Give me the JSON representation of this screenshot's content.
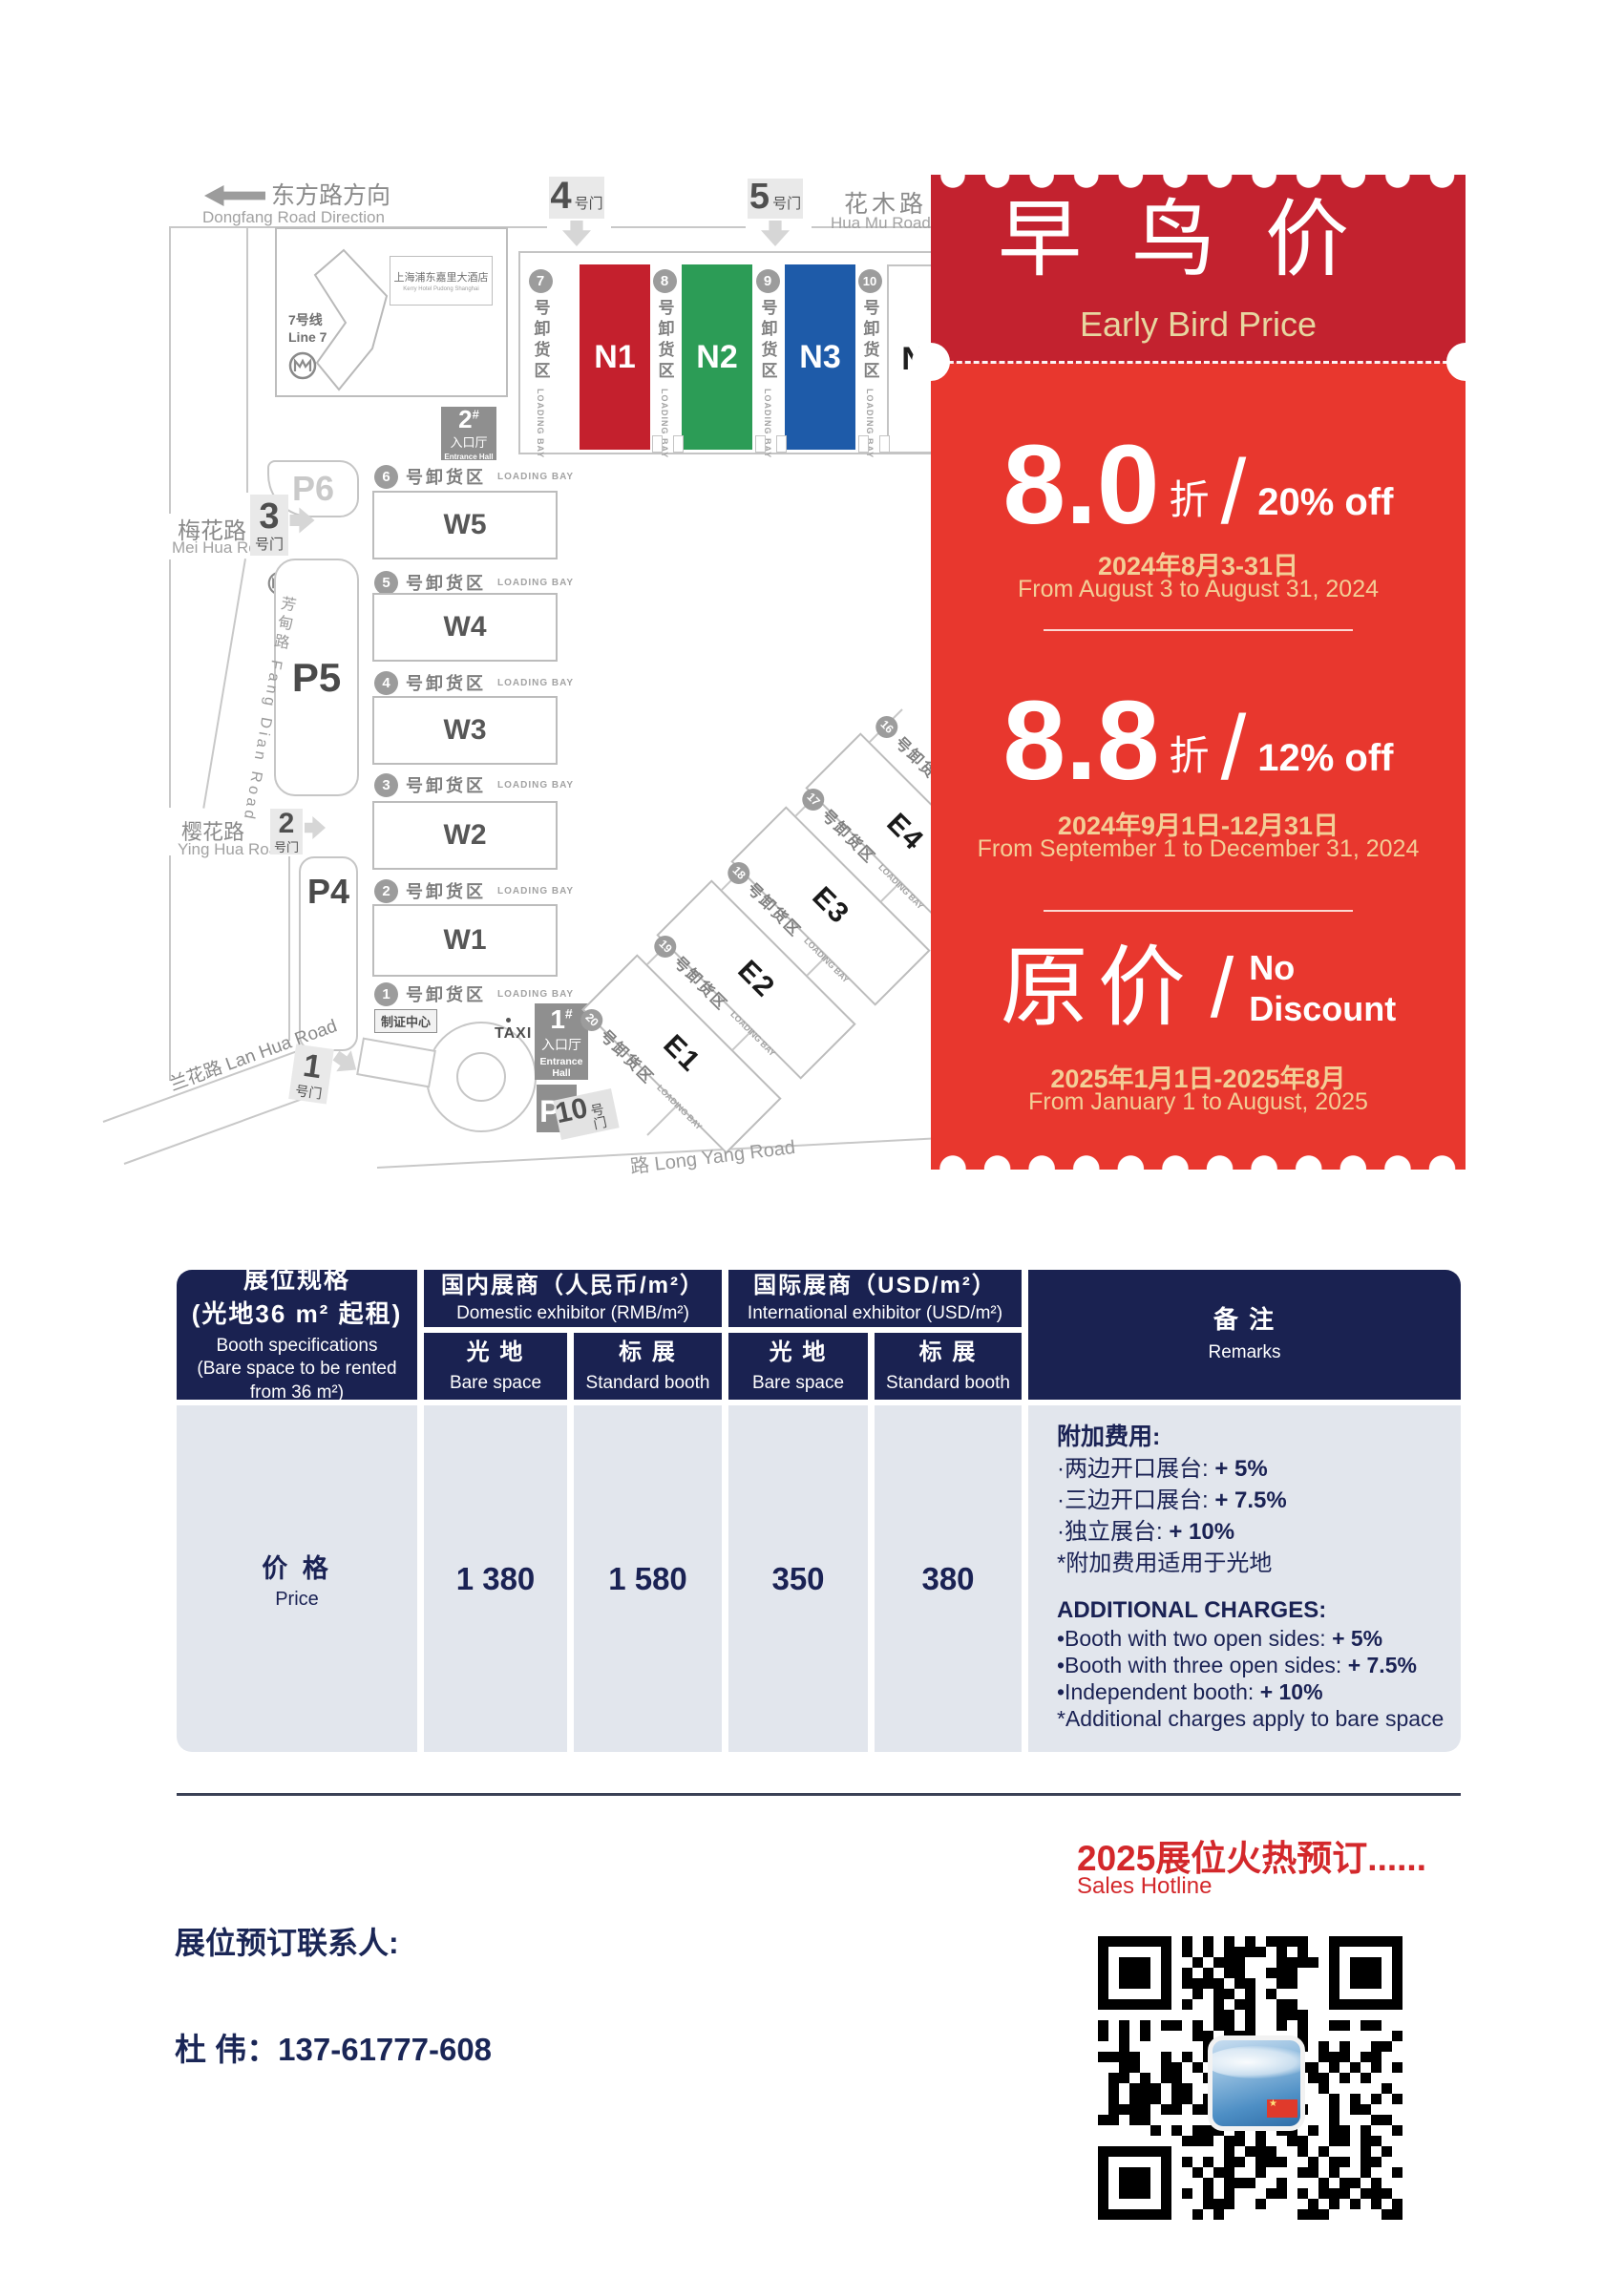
{
  "map": {
    "dongfang_cn": "东方路方向",
    "dongfang_en": "Dongfang Road Direction",
    "huamu_cn": "花木路",
    "huamu_en": "Hua Mu Road",
    "meihua_cn": "梅花路",
    "meihua_en": "Mei Hua Road",
    "yinghua_cn": "樱花路",
    "yinghua_en": "Ying Hua Road",
    "fangdian": "芳甸路 Fang Dian Road",
    "lanhua": "兰花路 Lan Hua Road",
    "longyang": "路 Long Yang Road",
    "hotel_cn": "上海浦东嘉里大酒店",
    "hotel_en": "Kerry Hotel Pudong Shanghai",
    "line7_cn": "7号线",
    "line7_en": "Line 7",
    "badge_center": "制证中心",
    "taxi": "TAXI",
    "gate_label": "号门",
    "gates": {
      "g1": "1",
      "g2": "2",
      "g3": "3",
      "g4": "4",
      "g5": "5",
      "g10": "10"
    },
    "parking": [
      "P6",
      "P5",
      "P4"
    ],
    "pvip": "P",
    "pvip_sub": "VIP",
    "hash": "#",
    "entrance1": {
      "num": "1",
      "cn": "入口厅",
      "en1": "Entrance",
      "en2": "Hall"
    },
    "entrance2": {
      "num": "2",
      "cn": "入口厅",
      "en": "Entrance Hall"
    },
    "halls_n": [
      "N1",
      "N2",
      "N3",
      "N4"
    ],
    "halls_w": [
      "W5",
      "W4",
      "W3",
      "W2",
      "W1"
    ],
    "halls_e": [
      "E1",
      "E2",
      "E3",
      "E4"
    ],
    "n_bays": [
      "7",
      "8",
      "9",
      "10"
    ],
    "w_bays": [
      "6",
      "5",
      "4",
      "3",
      "2",
      "1"
    ],
    "e_bays": [
      "16",
      "17",
      "18",
      "19",
      "20"
    ],
    "loading_cn": "号卸货区",
    "loading_en": "LOADING BAY"
  },
  "ticket": {
    "title_cn": "早鸟价",
    "title_en": "Early Bird Price",
    "tiers": [
      {
        "value": "8.0",
        "unit": "折",
        "slash": "/",
        "off": "20% off",
        "date_cn": "2024年8月3-31日",
        "date_en": "From August 3 to August 31, 2024"
      },
      {
        "value": "8.8",
        "unit": "折",
        "slash": "/",
        "off": "12% off",
        "date_cn": "2024年9月1日-12月31日",
        "date_en": "From September 1 to December 31, 2024"
      }
    ],
    "original": {
      "cn": "原价",
      "slash": "/",
      "en1": "No",
      "en2": "Discount",
      "date_cn": "2025年1月1日-2025年8月",
      "date_en": "From January 1 to August, 2025"
    }
  },
  "table": {
    "spec": {
      "cn1": "展位规格",
      "cn2": "(光地36 m² 起租)",
      "en1": "Booth specifications",
      "en2": "(Bare space to be rented",
      "en3": "from 36 m²)"
    },
    "groups": [
      {
        "cn": "国内展商（人民币/m²）",
        "en": "Domestic exhibitor (RMB/m²)"
      },
      {
        "cn": "国际展商（USD/m²）",
        "en": "International exhibitor (USD/m²)"
      }
    ],
    "subcols": [
      {
        "cn": "光 地",
        "en": "Bare space"
      },
      {
        "cn": "标 展",
        "en": "Standard booth"
      },
      {
        "cn": "光 地",
        "en": "Bare space"
      },
      {
        "cn": "标 展",
        "en": "Standard booth"
      }
    ],
    "remarks_header": {
      "cn": "备 注",
      "en": "Remarks"
    },
    "row_label": {
      "cn": "价 格",
      "en": "Price"
    },
    "values": [
      "1 380",
      "1 580",
      "350",
      "380"
    ],
    "remarks": {
      "cn_title": "附加费用:",
      "cn_items": [
        {
          "label": "·两边开口展台: ",
          "value": "+ 5%"
        },
        {
          "label": "·三边开口展台: ",
          "value": "+ 7.5%"
        },
        {
          "label": "·独立展台: ",
          "value": "+ 10%"
        },
        {
          "label": "*附加费用适用于光地",
          "value": ""
        }
      ],
      "en_title": "ADDITIONAL CHARGES:",
      "en_items": [
        {
          "label": "•Booth with two open sides: ",
          "value": "+ 5%"
        },
        {
          "label": "•Booth with three open sides: ",
          "value": "+ 7.5%"
        },
        {
          "label": "•Independent booth: ",
          "value": "+ 10%"
        },
        {
          "label": "*Additional charges apply to bare space",
          "value": ""
        }
      ]
    }
  },
  "footer": {
    "hotline_cn": "2025展位火热预订......",
    "hotline_en": "Sales Hotline",
    "contact_label": "展位预订联系人:",
    "contact_phone": "杜  伟：137-61777-608",
    "flag_star": "★"
  },
  "colors": {
    "navy": "#1A2251",
    "table_body": "#E2E6ED",
    "ticket_dark_red": "#C3222F",
    "ticket_red": "#E8372E",
    "gold": "#E7D6A0",
    "date_gold": "#F3CE96",
    "accent_red": "#D3282B",
    "hall_n1": "#C4202D",
    "hall_n2": "#2C9C56",
    "hall_n3": "#1E5BA9"
  }
}
